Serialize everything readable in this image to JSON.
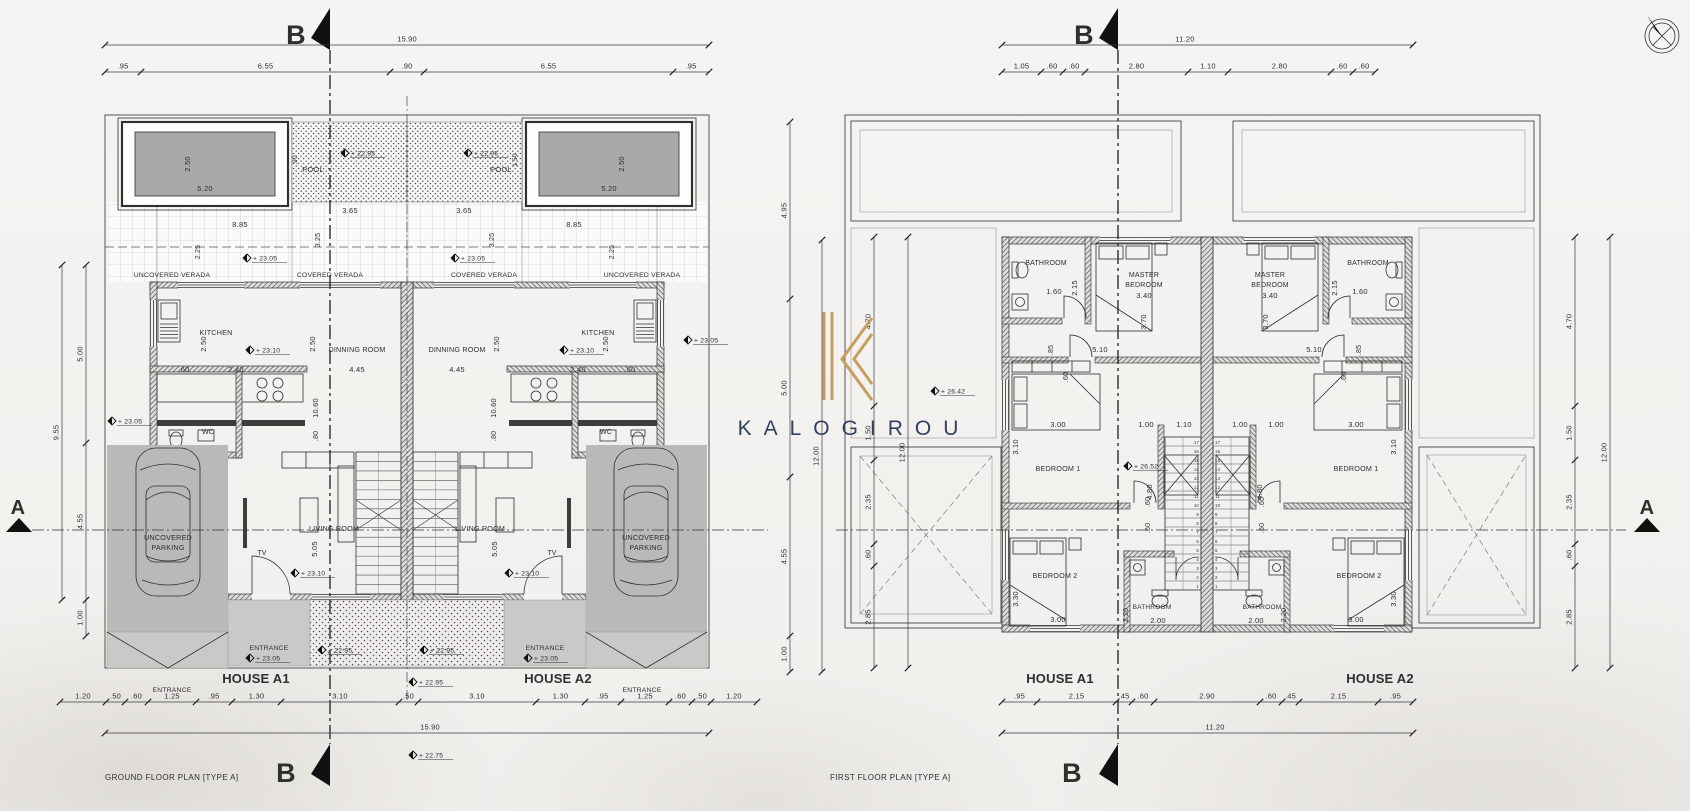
{
  "watermark": {
    "brand": "KALOGIROU",
    "gold": "#c69f60",
    "navy": "#33415e"
  },
  "left_plan": {
    "title": "GROUND FLOOR PLAN [TYPE A]",
    "houses": {
      "a1": "HOUSE A1",
      "a2": "HOUSE A2"
    },
    "sections": {
      "b": "B",
      "a": "A"
    },
    "dims": {
      "top_total": "15.90",
      "top_chain": [
        ".95",
        "6.55",
        ".90",
        "6.55",
        ".95"
      ],
      "bottom_chain": [
        "1.20",
        ".50",
        ".60",
        "1.25",
        ".95",
        "1.30",
        "3.10",
        ".50",
        "3.10",
        "1.30",
        ".95",
        "1.25",
        ".60",
        ".50",
        "1.20"
      ],
      "bottom_total": "15.90",
      "left_outer": "9.55",
      "left_chain": [
        "5.00",
        "4.55",
        "1.00"
      ],
      "right_chain": [
        "4.95",
        "5.00",
        "4.55",
        "1.00"
      ],
      "right_outer": "12.00",
      "pool_w": "5.20",
      "pool_d": "2.50",
      "deck_w": "3.65",
      "deck_edge_left": ".90",
      "deck_edge_right": "1.50",
      "verada_w": "8.85",
      "verada_d": "2.25",
      "verada_d2": "3.25",
      "kitchen_d": "2.50",
      "kitchen_u": ".60",
      "kitchen_w": "2.40",
      "dining_d": "2.50",
      "dining_w": "4.45",
      "hall_l": "10.60",
      "hall_w": ".80",
      "living_d": "5.05"
    },
    "rooms": {
      "pool": "POOL",
      "uncovered_verada": "UNCOVERED VERADA",
      "covered_verada": "COVERED VERADA",
      "kitchen": "KITCHEN",
      "dining": "DINNING ROOM",
      "wc": "WC",
      "living": "LIVING ROOM",
      "tv": "TV",
      "parking_line1": "UNCOVERED",
      "parking_line2": "PARKING",
      "entrance": "ENTRANCE"
    },
    "levels": {
      "pool": "+ 22.95",
      "verada": "+ 23.05",
      "kitchen": "+ 23.10",
      "side": "+ 23.05",
      "living": "+ 23.10",
      "porch": "+ 23.05",
      "walk": "+ 22.95",
      "front": "+ 22.95",
      "street": "+ 22.75"
    }
  },
  "right_plan": {
    "title": "FIRST FLOOR PLAN [TYPE A]",
    "houses": {
      "a1": "HOUSE A1",
      "a2": "HOUSE A2"
    },
    "sections": {
      "b": "B",
      "a": "A"
    },
    "dims": {
      "top_total": "11.20",
      "top_chain": [
        "1.05",
        ".60",
        ".60",
        "2.80",
        "1.10",
        "2.80",
        ".60",
        ".60"
      ],
      "bottom_chain": [
        ".95",
        "2.15",
        ".45",
        ".60",
        "2.90",
        ".60",
        ".45",
        "2.15",
        ".95"
      ],
      "bottom_total": "11.20",
      "left_chain": [
        "4.70",
        "1.50",
        "2.35",
        ".60",
        "2.85"
      ],
      "left_outer": "12.00",
      "right_chain": [
        "4.70",
        "1.50",
        "2.35",
        ".60",
        "2.85"
      ],
      "right_outer": "12.00",
      "bath_w": "1.60",
      "bath_d": "2.15",
      "master_w": "3.40",
      "master_d": "3.70",
      "upper_w": "5.10",
      "upper_s": ".85",
      "d60": ".60",
      "bed1_w": "3.00",
      "bed1_d": "3.10",
      "stair_w": "1.00",
      "stair_mid": "1.10",
      "stair_l": "4.80",
      "bed2_w": "3.00",
      "bed2_d": "3.30",
      "bath2_w": "2.00",
      "bath2_d": "2.20"
    },
    "rooms": {
      "bathroom": "BATHROOM",
      "master_line1": "MASTER",
      "master_line2": "BEDROOM",
      "bedroom1": "BEDROOM 1",
      "bedroom2": "BEDROOM 2"
    },
    "levels": {
      "terrace": "+ 26.42",
      "landing": "+ 26.52"
    },
    "stairs": {
      "steps": [
        "17",
        "16",
        "15",
        "14",
        "13",
        "12",
        "11",
        "10",
        "9",
        "8",
        "7",
        "6",
        "5",
        "4",
        "3",
        "2",
        "1"
      ]
    }
  }
}
